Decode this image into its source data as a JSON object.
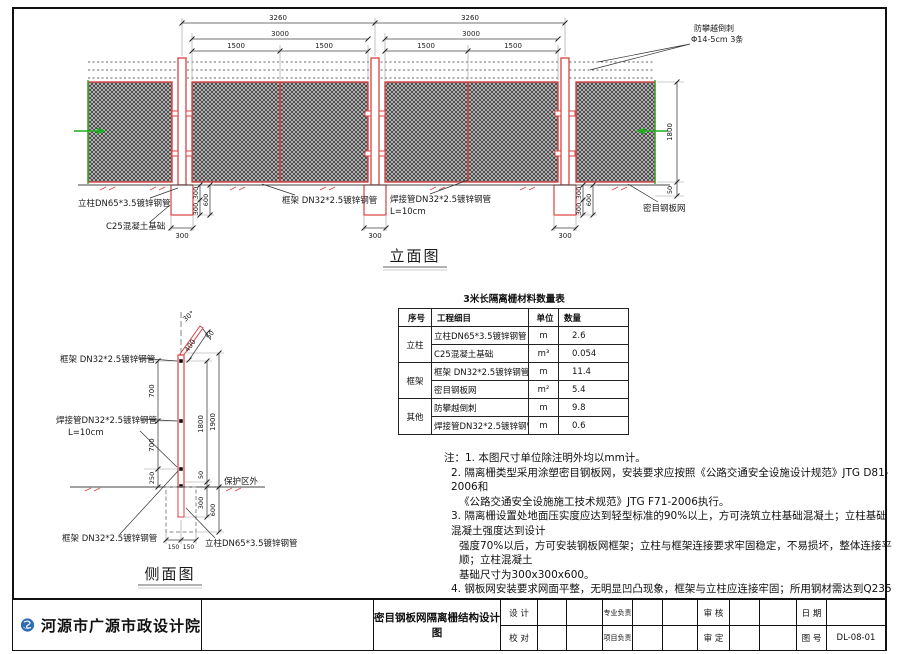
{
  "colors": {
    "red": "#d94040",
    "green": "#1fae1f",
    "dim_line": "#444444",
    "logo_blue": "#2e6db4"
  },
  "elev": {
    "title": "立面图",
    "dims": {
      "span": "3260",
      "frame": "3000",
      "half": "1500",
      "height": "1800",
      "gap": "50",
      "fw": "300",
      "fdh": "300",
      "fd": "600"
    },
    "labels": {
      "barb1": "防攀越倒刺",
      "barb2": "Φ14-5cm 3条",
      "post": "立柱DN65*3.5镀锌钢管",
      "foundation": "C25混凝土基础",
      "frame": "框架 DN32*2.5镀锌钢管",
      "weld": "焊接管DN32*2.5镀锌钢管",
      "weld_len": "L=10cm",
      "mesh": "密目钢板网"
    }
  },
  "side": {
    "title": "侧面图",
    "dims": {
      "angle": "30°",
      "arm": "400",
      "armgap": "50",
      "seg": "700",
      "seg_low": "250",
      "gap": "50",
      "h1": "1800",
      "h2": "1900",
      "d1": "300",
      "d2": "600",
      "w": "150"
    },
    "labels": {
      "frame": "框架 DN32*2.5镀锌钢管",
      "weld": "焊接管DN32*2.5镀锌钢管",
      "weld_len": "L=10cm",
      "zone": "保护区外",
      "post": "立柱DN65*3.5镀锌钢管"
    }
  },
  "table": {
    "title": "3米长隔离栅材料数量表",
    "headers": [
      "序号",
      "工程细目",
      "单位",
      "数量"
    ],
    "groups": [
      {
        "name": "立柱",
        "rows": [
          {
            "item": "立柱DN65*3.5镀锌钢管",
            "unit": "m",
            "qty": "2.6"
          },
          {
            "item": "C25混凝土基础",
            "unit": "m³",
            "qty": "0.054"
          }
        ]
      },
      {
        "name": "框架",
        "rows": [
          {
            "item": "框架 DN32*2.5镀锌钢管",
            "unit": "m",
            "qty": "11.4"
          },
          {
            "item": "密目钢板网",
            "unit": "m²",
            "qty": "5.4"
          }
        ]
      },
      {
        "name": "其他",
        "rows": [
          {
            "item": "防攀越倒刺",
            "unit": "m",
            "qty": "9.8"
          },
          {
            "item": "焊接管DN32*2.5镀锌钢管",
            "unit": "m",
            "qty": "0.6"
          }
        ]
      }
    ]
  },
  "notes": {
    "lines": [
      "注：1. 本图尺寸单位除注明外均以mm计。",
      "2. 隔离栅类型采用涂塑密目钢板网，安装要求应按照《公路交通安全设施设计规范》JTG D81-2006和",
      "《公路交通安全设施施工技术规范》JTG F71-2006执行。",
      "3. 隔离栅设置处地面压实度应达到轻型标准的90%以上，方可浇筑立柱基础混凝土；立柱基础混凝土强度达到设计",
      "强度70%以后，方可安装钢板网框架；立柱与框架连接要求牢固稳定，不易损坏，整体连接平顺；立柱混凝土",
      "基础尺寸为300x300x600。",
      "4. 钢板网安装要求网面平整，无明显凹凸现象，框架与立柱应连接牢固；所用钢材需达到Q235钢的要求。",
      "立柱及框架镀锌钢管表面刷涂绿色防锈漆。",
      "5. 隔离栅框架标准单位长度为3m，两端不足处可适当调整标准段。"
    ]
  },
  "titleblock": {
    "company": "河源市广源市政设计院",
    "drawing_title": "密目钢板网隔离栅结构设计图",
    "design": "设  计",
    "proof": "校  对",
    "pro_lead": "专业负责",
    "proj_lead": "项目负责",
    "review": "审  核",
    "approve": "审  定",
    "date": "日  期",
    "no_label": "图  号",
    "drawing_no": "DL-08-01"
  }
}
